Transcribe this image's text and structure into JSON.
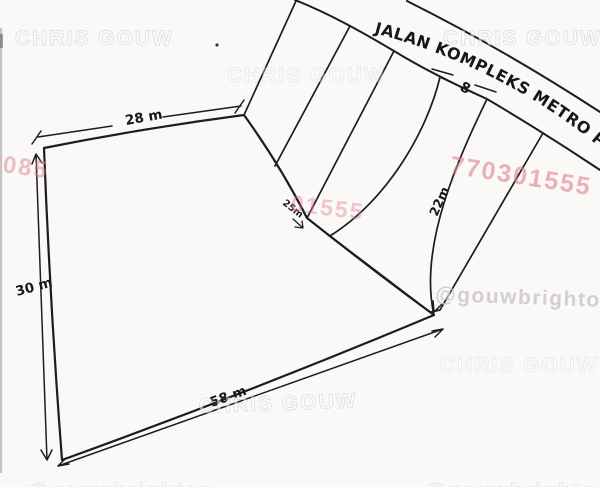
{
  "road": {
    "name": "JALAN KOMPLEKS METRO PERMATA"
  },
  "dimensions": {
    "top_width": "28 m",
    "left_depth": "30 m",
    "bottom_width": "58 m",
    "strip_depth": "22m",
    "strip_width": "8",
    "junction": "25m"
  },
  "watermarks": {
    "brand": "CHRIS GOUW",
    "handle": "@gouwbrighton",
    "phone_fragment_left": "085",
    "phone_fragment_middle": "01555",
    "phone_fragment_right": "770301555"
  },
  "colors": {
    "ink": "#1d1b24",
    "hatch_dark": "#2b2532",
    "hatch_maroon": "#50263a",
    "watermark_pink": "#e0808f",
    "watermark_gray": "#c9c3c3",
    "paper": "#faf9f8"
  }
}
